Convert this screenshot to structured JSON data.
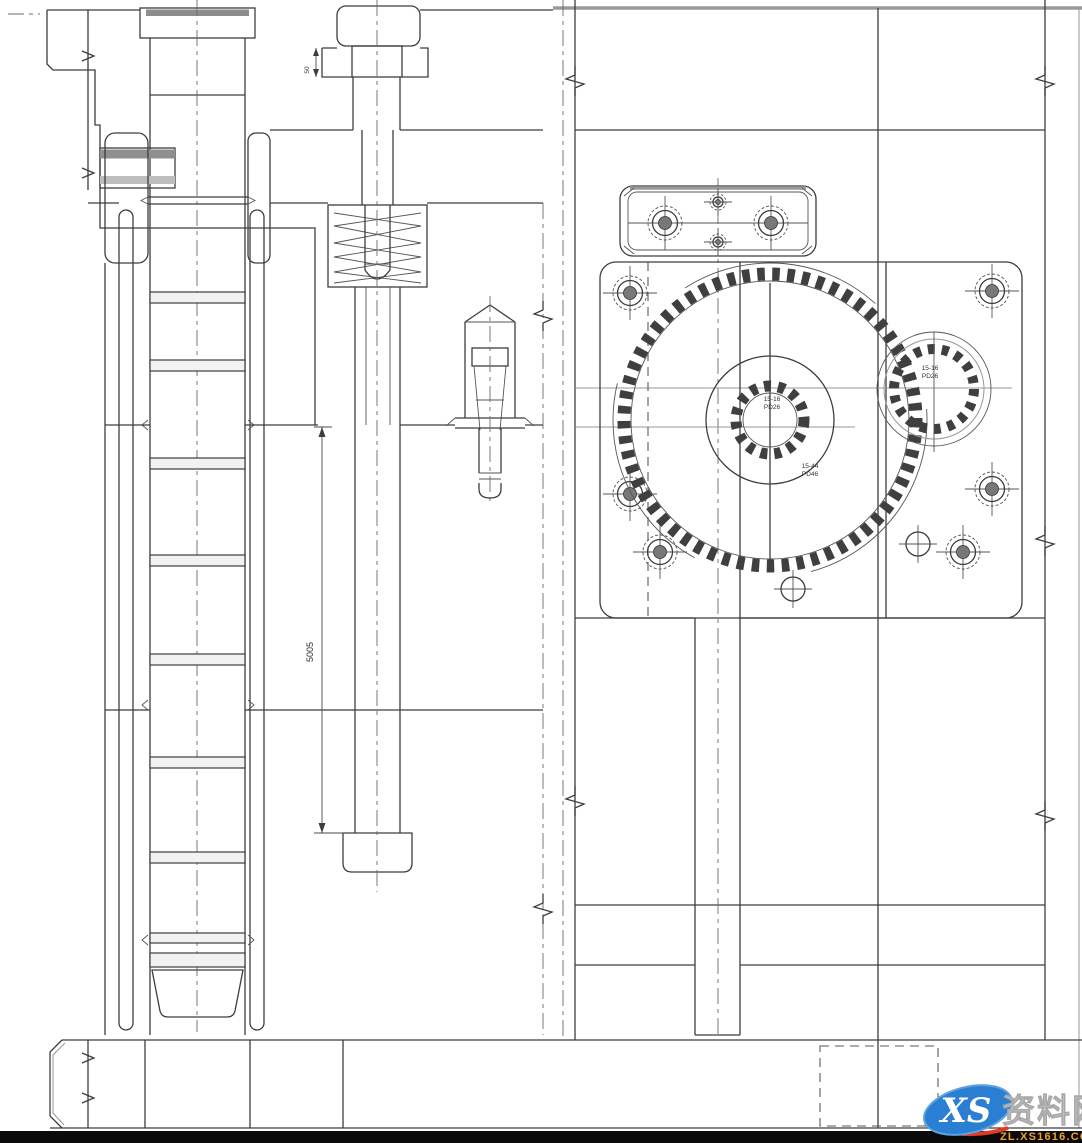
{
  "drawing": {
    "kind": "mold-gear-assembly-section",
    "labels": {
      "shaft_dim": "5005",
      "bolt_dim": "50",
      "sun_gear": {
        "line1": "15-16",
        "line2": "PD26"
      },
      "ring_gear": {
        "line1": "15-44",
        "line2": "PD46"
      },
      "idler_gear": {
        "line1": "15-16",
        "line2": "PD26"
      }
    }
  },
  "watermark": {
    "logo": "XS",
    "name": "资料网",
    "url": "ZL.XS1616.COM"
  },
  "colors": {
    "line": "#3d3d3d",
    "light_line": "#979797",
    "background": "#ffffff",
    "bottom_bar": "#0a0a0a",
    "watermark_blue": "#2a7fd2",
    "watermark_red": "#e23b28",
    "watermark_gray": "#c7c7c7",
    "watermark_orange": "#f2a12c"
  }
}
